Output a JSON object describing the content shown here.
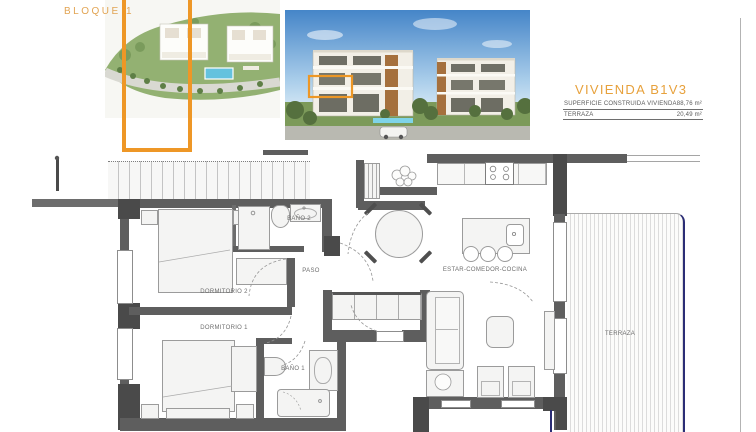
{
  "header": {
    "bloque_label": "BLOQUE 1",
    "vivienda_title": "VIVIENDA B1V3"
  },
  "area_table": {
    "rows": [
      {
        "label": "SUPERFICIE CONSTRUIDA VIVIENDA",
        "value": "88,76 m²"
      },
      {
        "label": "TERRAZA",
        "value": "20,49 m²"
      }
    ]
  },
  "floorplan": {
    "rooms": {
      "dormitorio_2": "DORMITORIO 2",
      "dormitorio_1": "DORMITORIO 1",
      "bano_2": "BAÑO 2",
      "bano_1": "BAÑO 1",
      "paso": "PASO",
      "estar_comedor_cocina": "ESTAR-COMEDOR-COCINA",
      "terraza": "TERRAZA"
    }
  },
  "colors": {
    "accent_orange": "#E7A13C",
    "highlight_orange": "#EE9726",
    "wall_gray": "#5E5E5E",
    "terrace_line_navy": "#2B2D75"
  }
}
